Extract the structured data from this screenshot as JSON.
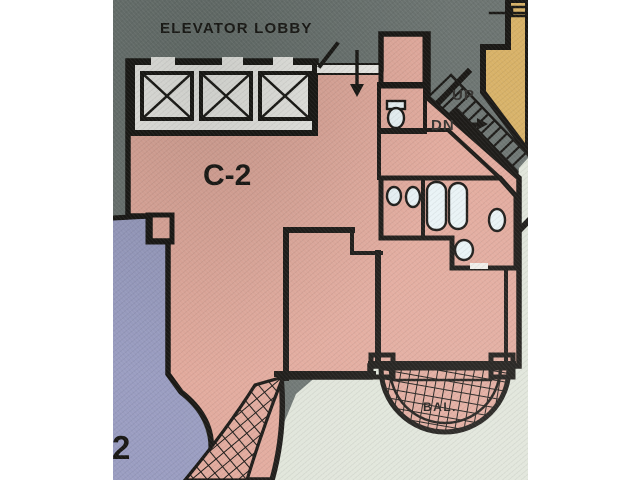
{
  "plan": {
    "labels": {
      "elevator_lobby": "ELEVATOR LOBBY",
      "unit_c2": "C-2",
      "stairs_up": "UP",
      "stairs_down": "DN",
      "balcony": "BAL.",
      "adjacent_unit_number": "2"
    },
    "colors": {
      "page_background": "#ffffff",
      "photo_background": "#6d7572",
      "unit_c2_fill": "#e2aa9d",
      "adjacent_unit_fill": "#9a9dc1",
      "corner_unit_fill": "#d8b268",
      "bathroom_tile": "#2aa8d6",
      "outside_area": "#e0e5da",
      "lobby_floor": "#efeeea",
      "line": "#1a1815"
    }
  }
}
